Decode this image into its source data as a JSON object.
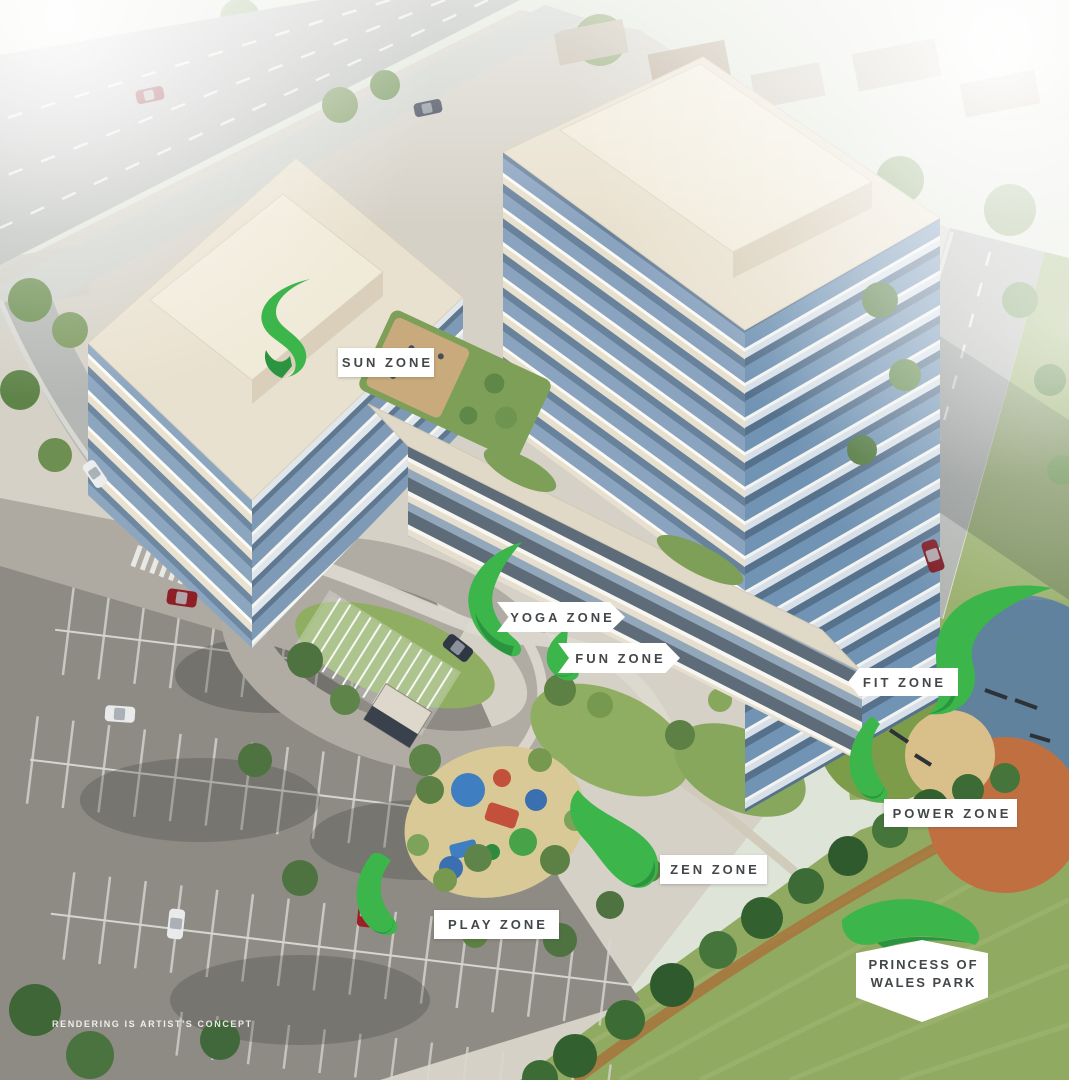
{
  "zone_labels": {
    "sun": "SUN ZONE",
    "yoga": "YOGA ZONE",
    "fun": "FUN ZONE",
    "fit": "FIT ZONE",
    "power": "POWER ZONE",
    "zen": "ZEN ZONE",
    "play": "PLAY ZONE"
  },
  "park_label": {
    "line1": "PRINCESS OF",
    "line2": "WALES PARK"
  },
  "disclaimer": "RENDERING IS ARTIST'S CONCEPT",
  "colors": {
    "ribbon_green": "#3cb54a",
    "ribbon_green_dark": "#2a9440",
    "label_background": "#ffffff",
    "label_text": "#43474a"
  }
}
